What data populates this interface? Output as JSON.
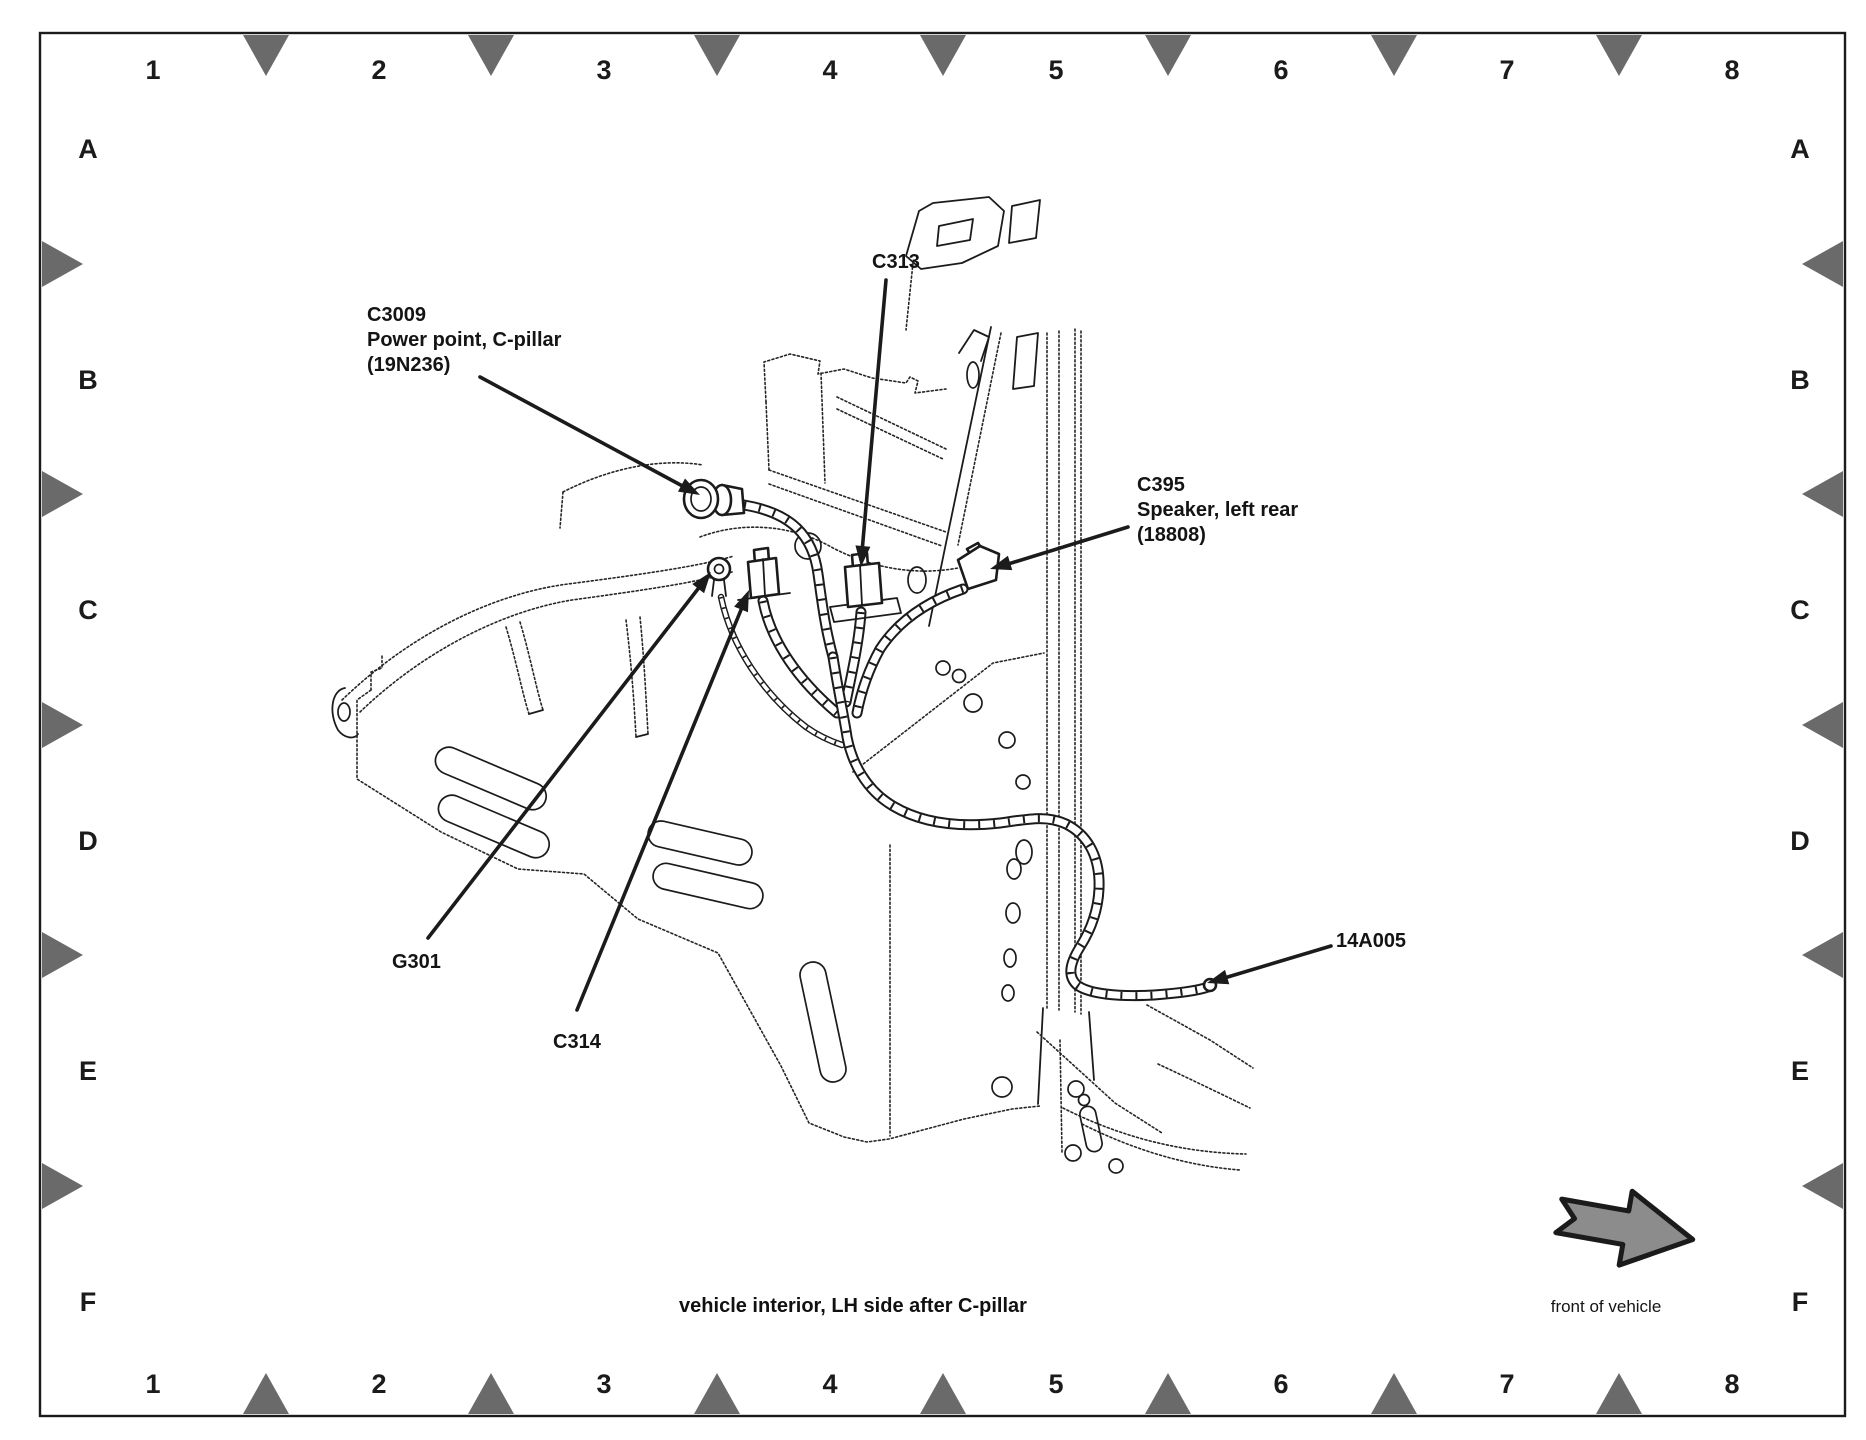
{
  "frame": {
    "columns": [
      "1",
      "2",
      "3",
      "4",
      "5",
      "6",
      "7",
      "8"
    ],
    "rows": [
      "A",
      "B",
      "C",
      "D",
      "E",
      "F"
    ]
  },
  "labels": {
    "c3009": {
      "line1": "C3009",
      "line2": "Power point, C-pillar",
      "line3": "(19N236)"
    },
    "c313": {
      "line1": "C313"
    },
    "c395": {
      "line1": "C395",
      "line2": "Speaker, left rear",
      "line3": "(18808)"
    },
    "g301": {
      "line1": "G301"
    },
    "c314": {
      "line1": "C314"
    },
    "h14a005": {
      "line1": "14A005"
    }
  },
  "caption": "vehicle interior, LH side after C-pillar",
  "front_arrow_label": "front of vehicle",
  "colors": {
    "line": "#1b1b1b",
    "triangle": "#6a6a6a",
    "front_arrow_fill": "#8c8c8c",
    "background": "#ffffff"
  }
}
